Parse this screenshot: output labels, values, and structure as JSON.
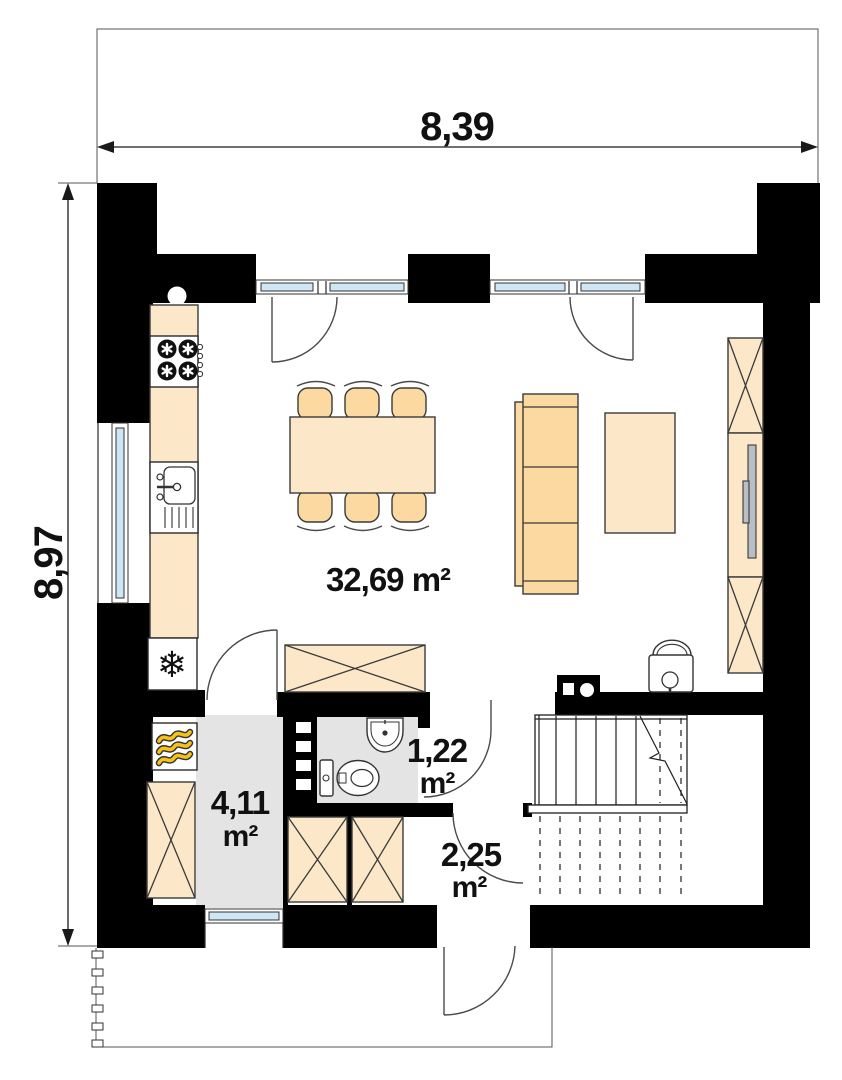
{
  "dims": {
    "w": "8,39",
    "h": "8,97"
  },
  "rooms": {
    "living": {
      "name": "living-dining-kitchen",
      "area": "32,69 m²"
    },
    "hall": {
      "name": "hall",
      "value": "4,11",
      "unit": "m²"
    },
    "wc": {
      "name": "wc",
      "value": "1,22",
      "unit": "m²"
    },
    "vestibule": {
      "name": "vestibule",
      "value": "2,25",
      "unit": "m²"
    }
  },
  "icons": {
    "freezer": "❄"
  },
  "colors": {
    "wall": "#000000",
    "furniture_light": "#fce8c9",
    "furniture_mid": "#fbd9a1",
    "glazing": "#cfe7f5",
    "floor_gray": "#e4e4e4",
    "heater_yellow": "#f6c21a",
    "tv_gray": "#b9bec4"
  }
}
